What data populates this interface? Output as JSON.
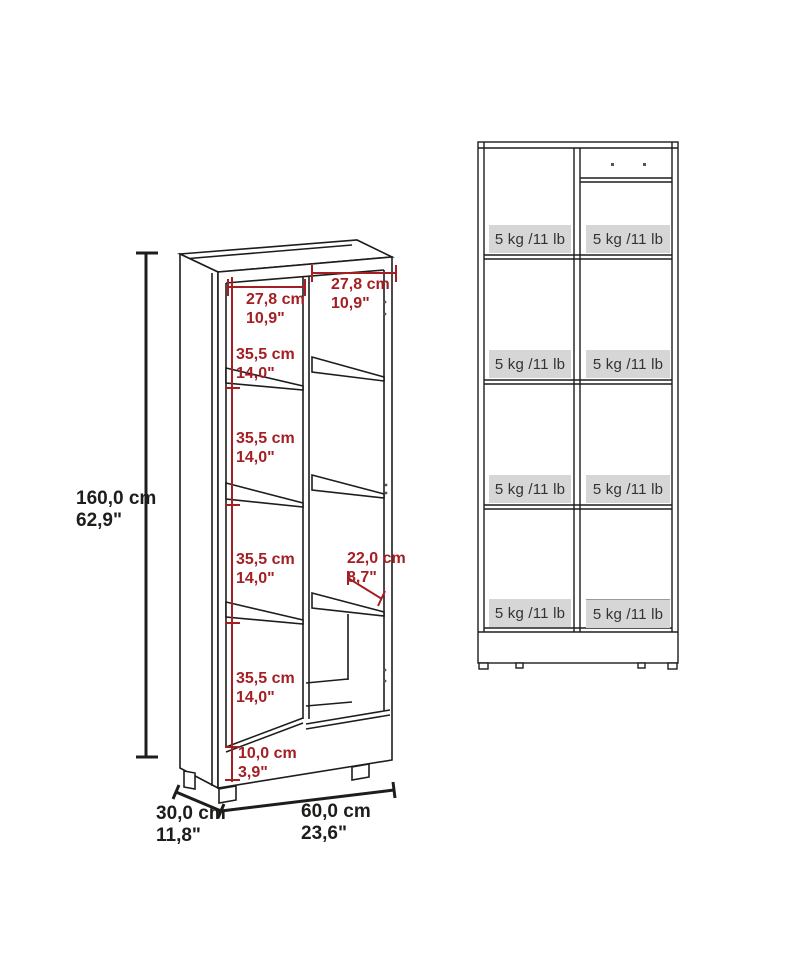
{
  "diagram_title": "Bookcase dimension diagram",
  "colors": {
    "line": "#1d1d1b",
    "dimension_red": "#a31f24",
    "band_fill": "#d6d6d6",
    "band_text": "#333333"
  },
  "left_view": {
    "height": {
      "cm": "160,0 cm",
      "in": "62,9\""
    },
    "depth": {
      "cm": "30,0 cm",
      "in": "11,8\""
    },
    "width": {
      "cm": "60,0 cm",
      "in": "23,6\""
    },
    "left_column_width": {
      "cm": "27,8 cm",
      "in": "10,9\""
    },
    "right_column_width": {
      "cm": "27,8 cm",
      "in": "10,9\""
    },
    "shelf_spacings": [
      {
        "cm": "35,5 cm",
        "in": "14,0\""
      },
      {
        "cm": "35,5 cm",
        "in": "14,0\""
      },
      {
        "cm": "35,5 cm",
        "in": "14,0\""
      },
      {
        "cm": "35,5 cm",
        "in": "14,0\""
      }
    ],
    "shelf_depth": {
      "cm": "22,0 cm",
      "in": "8,7\""
    },
    "base_height": {
      "cm": "10,0 cm",
      "in": "3,9\""
    }
  },
  "right_view": {
    "bands": [
      "5 kg /11 lb",
      "5 kg /11 lb",
      "5 kg /11 lb",
      "5 kg /11 lb",
      "5 kg /11 lb",
      "5 kg /11 lb",
      "5 kg /11 lb",
      "5 kg /11 lb"
    ]
  }
}
